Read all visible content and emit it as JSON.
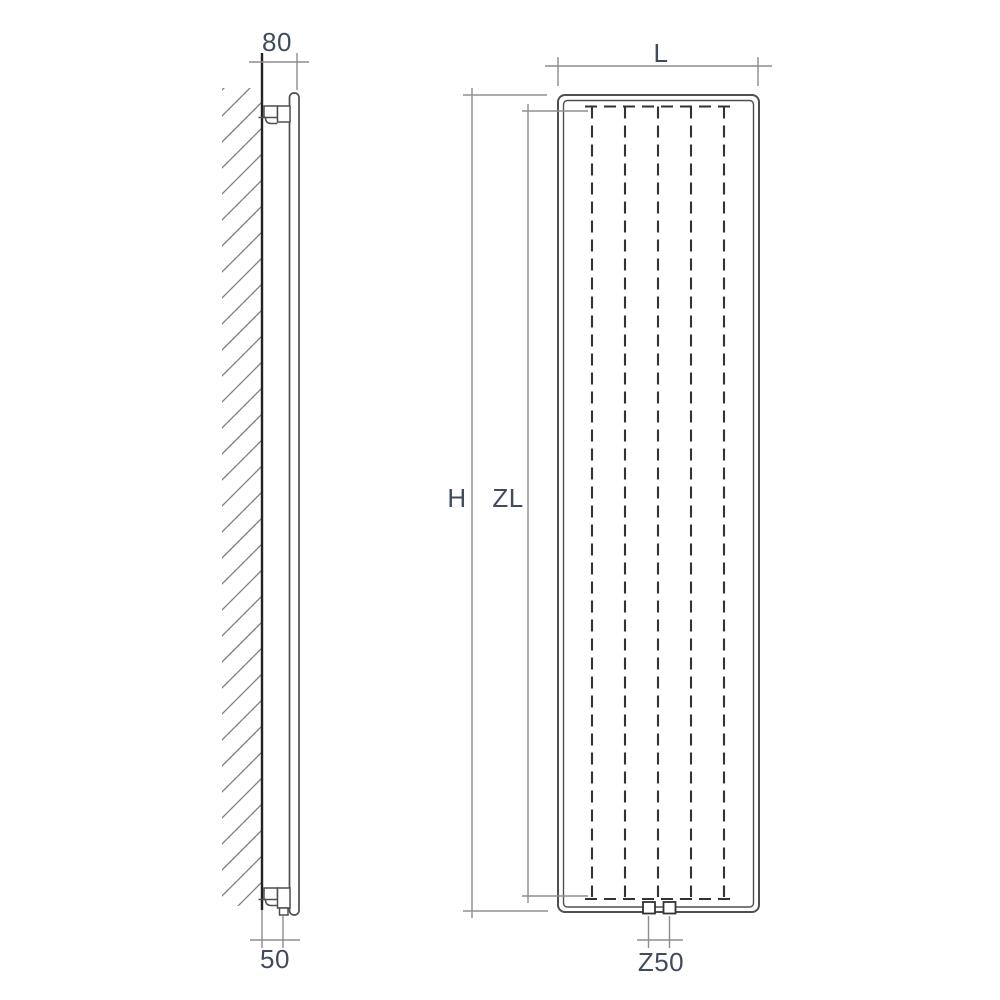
{
  "diagram": {
    "type": "technical-drawing",
    "subject": "vertical-radiator-dimension-diagram",
    "views": {
      "side": {
        "name": "side view with wall section",
        "labels": {
          "depth": "80",
          "pipe_offset": "50"
        }
      },
      "front": {
        "name": "front view",
        "labels": {
          "width": "L",
          "height": "H",
          "element_height": "ZL",
          "connection_spacing": "Z50"
        },
        "element_count": 5,
        "connection_count": 2
      }
    },
    "colors": {
      "background": "#ffffff",
      "object_line": "#4f4f4f",
      "dashed_line": "#333333",
      "dimension_line": "#8d8d8d",
      "wall_line": "#222222",
      "hatch_line": "#7d7d7d",
      "label_text": "#414b5e"
    }
  }
}
